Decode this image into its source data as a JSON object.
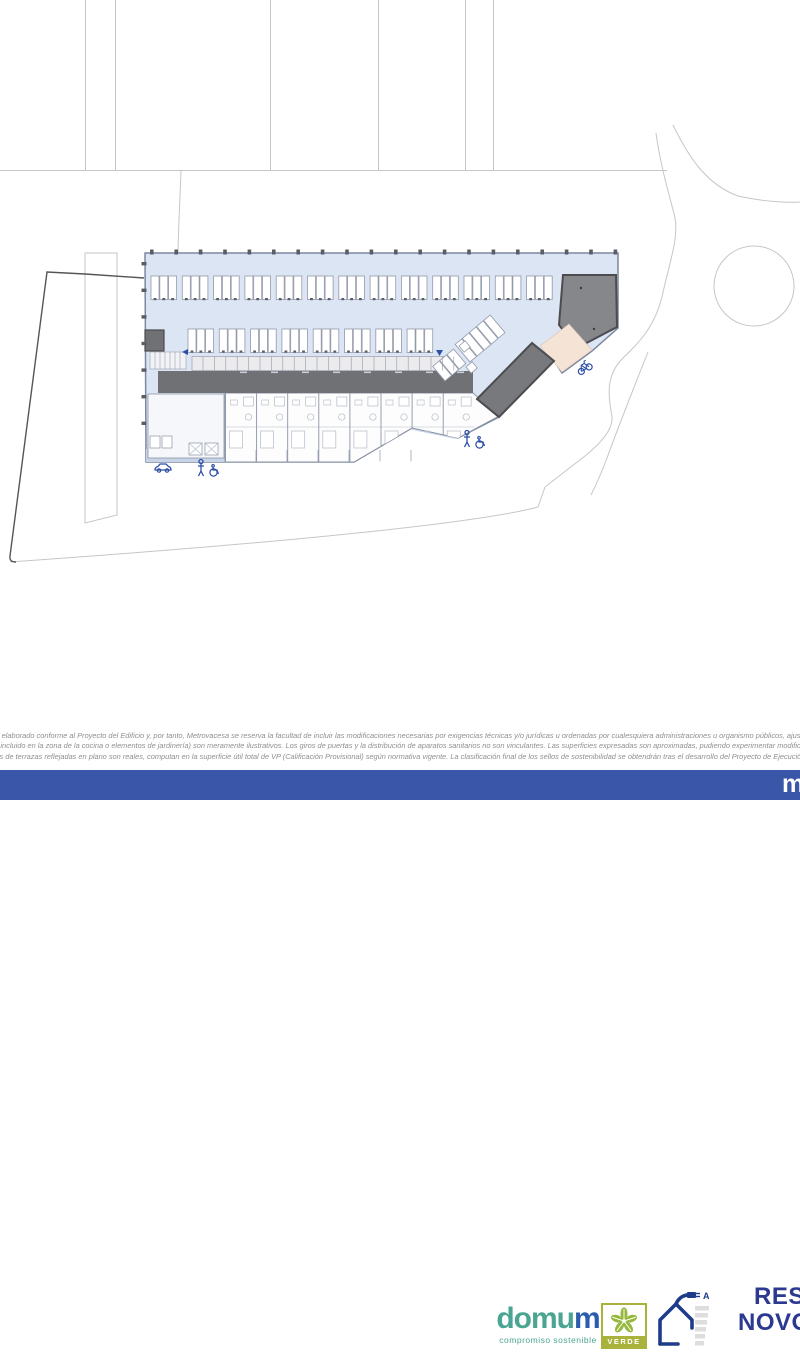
{
  "plan": {
    "title_hint": "residential ground floor / garage site plan",
    "colors": {
      "floor": "#dce5f4",
      "floor_stroke": "#7c87a0",
      "terrace": "#c9d4e9",
      "stall_fill": "#ffffff",
      "stall_stroke": "#939aa9",
      "storage_fill": "#ebebee",
      "corridor": "#6f7175",
      "ramp_block": "#85878b",
      "wedge": "#77797d",
      "dark_stroke": "#4c4c4f",
      "beige": "#f5e3d6",
      "site_line": "#c6c6c6",
      "boundary": "#555555",
      "icon_blue": "#2b4ea6",
      "tick": "#5a5d66",
      "pale": "#b4bac7"
    },
    "icons": [
      "car-icon",
      "pedestrian-icon",
      "wheelchair-icon",
      "pedestrian-icon",
      "wheelchair-icon",
      "bicycle-icon",
      "entrance-arrow-icon",
      "entrance-arrow-icon"
    ]
  },
  "footer": {
    "brand": {
      "prefix": "domu",
      "suffix": "m",
      "tagline": "compromiso sostenible",
      "color_main": "#4aa593",
      "color_m": "#2b5cad"
    },
    "verde": {
      "label": "VERDE",
      "color": "#a9b23b"
    },
    "energy": {
      "rating": "A",
      "color": "#1f3c8a"
    },
    "residential": {
      "line1": "RES",
      "line2": "NOVO",
      "color": "#2b3990"
    },
    "disclaimer": {
      "color": "#8f8f8f",
      "lines": [
        "sido elaborado conforme al Proyecto del Edificio y, por tanto, Metrovacesa se reserva la facultad de incluir las modificaciones necesarias por exigencias técnicas y/o jurídicas u ordenadas por cualesquiera administraciones u organismo públicos, ajustándolos",
        "ario incluido en la zona de la cocina o elementos de jardinería) son meramente ilustrativos. Los giros de puertas y la distribución de aparatos sanitarios no son vinculantes. Las superficies expresadas son aproximadas, pudiendo experimentar modificaciones por",
        "útiles de terrazas reflejadas en plano son reales, computan en la superficie útil total de VP (Calificación Provisional) según normativa vigente. La clasificación final de los sellos de sostenibilidad se obtendrán tras el desarrollo del Proyecto de Ejecución.\""
      ]
    },
    "bottom_bar": {
      "color": "#3a56a9",
      "text": "m"
    }
  }
}
